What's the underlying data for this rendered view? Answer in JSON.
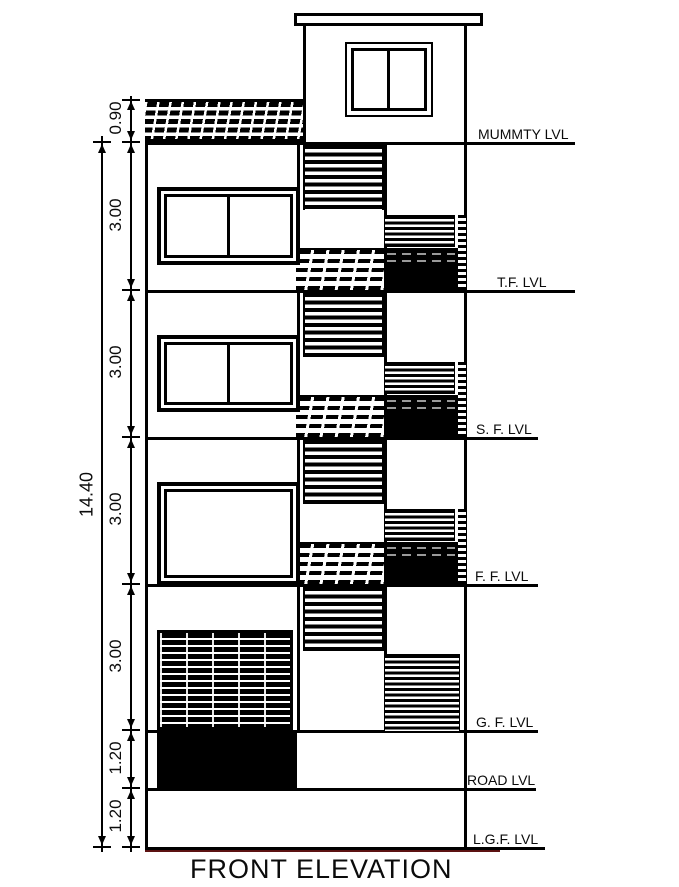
{
  "drawing": {
    "title": "FRONT ELEVATION"
  },
  "levels": {
    "mummty": "MUMMTY LVL",
    "tf": "T.F. LVL",
    "sf": "S. F. LVL",
    "ff": "F. F. LVL",
    "gf": "G. F. LVL",
    "road": "ROAD LVL",
    "lgf": "L.G.F. LVL"
  },
  "dimensions": {
    "parapet_height": "0.90",
    "floor_heights": [
      "3.00",
      "3.00",
      "3.00",
      "3.00"
    ],
    "plinth_heights": [
      "1.20",
      "1.20"
    ],
    "total_height": "14.40"
  },
  "colors": {
    "ink": "#000000",
    "ground_line": "#5c1212",
    "title_underline": "#4a4a4a"
  }
}
